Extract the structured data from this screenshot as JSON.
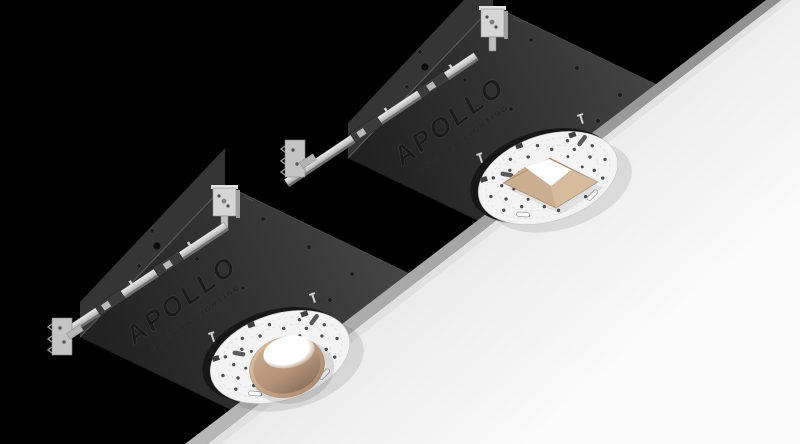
{
  "background": {
    "color": "#000000"
  },
  "ceiling": {
    "surface_color": "#f5f5f5",
    "edge_color": "#a8a8a8"
  },
  "branding": {
    "logo": "APOLLO",
    "byline": "BY NORA LIGHTING"
  },
  "fixtures": [
    {
      "name": "recessed-downlight-round",
      "position": "lower-left",
      "trim_style": "round",
      "trim_finish_color": "#c3a083",
      "lamp_state": "on"
    },
    {
      "name": "recessed-downlight-square",
      "position": "upper-right",
      "trim_style": "square",
      "trim_finish_color": "#cfae90",
      "lamp_state": "on"
    }
  ],
  "materials": {
    "housing_color": "#2e2e2e",
    "mounting_plate_color": "#f3f3f3",
    "hanger_bar_color": "#c9c9c9",
    "glow_color": "#ffffff"
  }
}
